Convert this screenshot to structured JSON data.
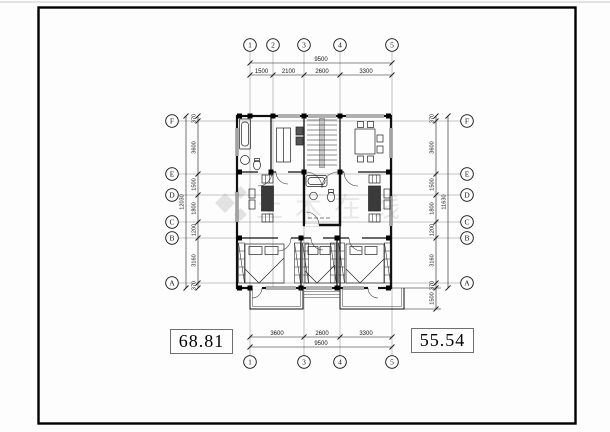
{
  "labels": {
    "left_area": "68.81",
    "right_area": "55.54"
  },
  "watermark": {
    "text": "土木在线",
    "color": "#e2e2e2"
  },
  "grids": {
    "top": [
      "1",
      "2",
      "3",
      "4",
      "5"
    ],
    "bottom": [
      "1",
      "3",
      "4",
      "5"
    ],
    "left": [
      "F",
      "E",
      "D",
      "C",
      "B",
      "A"
    ],
    "right": [
      "F",
      "E",
      "D",
      "C",
      "B",
      "A"
    ]
  },
  "dims": {
    "top": {
      "total": "9500",
      "segments": [
        "1500",
        "2100",
        "2600",
        "3300"
      ]
    },
    "bottom": {
      "total": "9500",
      "segments": [
        "3600",
        "2600",
        "3300"
      ]
    },
    "left": {
      "total": "12030",
      "segments": [
        "370",
        "3600",
        "1500",
        "1800",
        "1200",
        "3160",
        "370"
      ]
    },
    "right": {
      "total": "11630",
      "segments": [
        "370",
        "3600",
        "1500",
        "1800",
        "1200",
        "3160",
        "370"
      ],
      "balcony": "1500"
    }
  },
  "colors": {
    "ink": "#141414",
    "grid": "#7a7a7a",
    "frame": "#000000"
  }
}
